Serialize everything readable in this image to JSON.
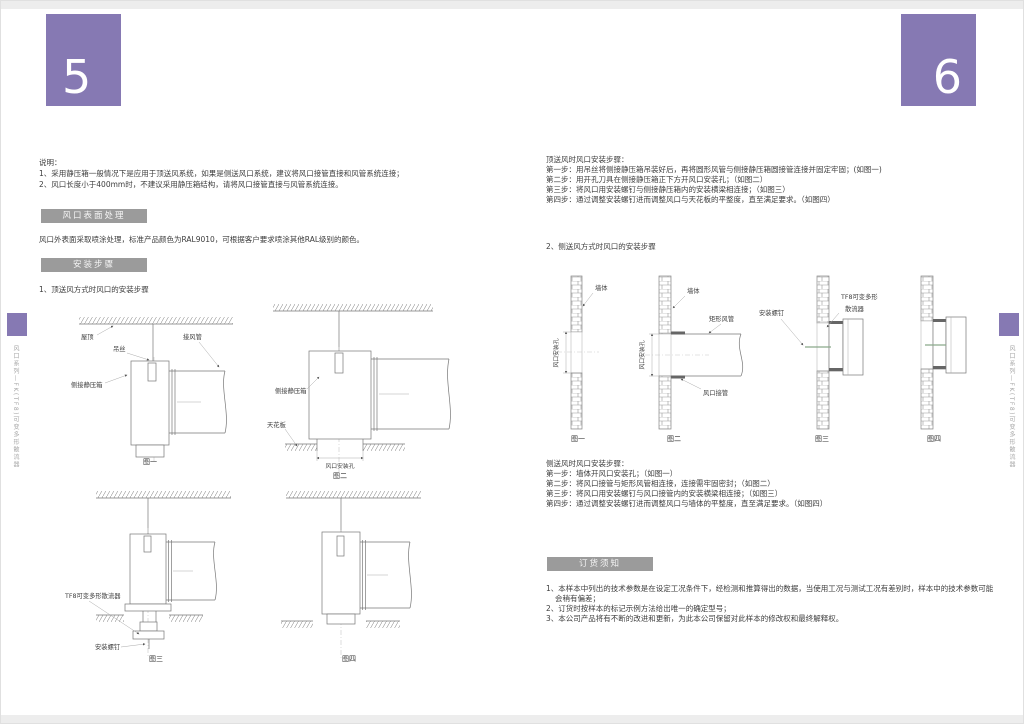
{
  "accent_color": "#8679b3",
  "header_gray": "#9b9b9b",
  "left": {
    "page_number": "5",
    "side_tab": "风口系列—FK(TF8)可变多形散流器",
    "notes_title": "说明：",
    "notes_1": "1、采用静压箱一般情况下是应用于顶送风系统，如果是侧送风口系统，建议将风口接管直接和风管系统连接；",
    "notes_2": "2、风口长度小于400mm时，不建议采用静压箱结构，请将风口接管直接与风管系统连接。",
    "surface_header": "风口表面处理",
    "surface_body": "风口外表面采取喷涂处理，标准产品颜色为RAL9010，可根据客户要求喷涂其他RAL级别的颜色。",
    "install_header": "安装步骤",
    "install_subtitle": "1、顶送风方式时风口的安装步骤",
    "fig1": {
      "caption": "图一",
      "roof": "屋顶",
      "wire": "吊丝",
      "duct": "接风管",
      "plenum": "侧接静压箱"
    },
    "fig2": {
      "caption": "图二",
      "plenum": "侧接静压箱",
      "ceiling": "天花板",
      "hole": "风口安装孔"
    },
    "fig3": {
      "caption": "图三",
      "diffuser": "TF8可变多形散流器",
      "screws": "安装螺钉"
    },
    "fig4": {
      "caption": "图四"
    }
  },
  "right": {
    "page_number": "6",
    "side_tab": "风口系列—FK(TF8)可变多形散流器",
    "top_title": "顶送风时风口安装步骤：",
    "top_steps": [
      "第一步：用吊丝将侧接静压箱吊装好后，再将圆形风管与侧接静压箱圆接管连接并固定牢固；(如图一)",
      "第二步：用开孔刀具在侧接静压箱正下方开风口安装孔；（如图二）",
      "第三步：将风口用安装螺钉与侧接静压箱内的安装横梁相连接；（如图三）",
      "第四步：通过调整安装螺钉进而调整风口与天花板的平整度，直至满足要求。（如图四）"
    ],
    "side_subtitle": "2、侧送风方式时风口的安装步骤",
    "fig1": {
      "caption": "图一",
      "wall": "墙体",
      "hole": "风口安装孔"
    },
    "fig2": {
      "caption": "图二",
      "wall": "墙体",
      "rect_duct": "矩形风管",
      "outlet_pipe": "风口接管",
      "hole": "风口安装孔"
    },
    "fig3": {
      "caption": "图三",
      "screws": "安装螺钉",
      "diffuser_line1": "TF8可变多形",
      "diffuser_line2": "散流器"
    },
    "fig4": {
      "caption": "图四"
    },
    "side_title": "侧送风时风口安装步骤：",
    "side_steps": [
      "第一步：墙体开风口安装孔；（如图一）",
      "第二步：将风口接管与矩形风管相连接，连接需牢固密封；（如图二）",
      "第三步：将风口用安装螺钉与风口接管内的安装横梁相连接；（如图三）",
      "第四步：通过调整安装螺钉进而调整风口与墙体的平整度，直至满足要求。（如图四）"
    ],
    "ordering_header": "订货须知",
    "ordering_items": [
      "1、本样本中列出的技术参数是在设定工况条件下，经检测和推算得出的数据，当使用工况与测试工况有差别时，样本中的技术参数可能会稍有偏差；",
      "2、订货时按样本的标记示例方法给出唯一的确定型号；",
      "3、本公司产品将有不断的改进和更新，为此本公司保留对此样本的修改权和最终解释权。"
    ]
  }
}
